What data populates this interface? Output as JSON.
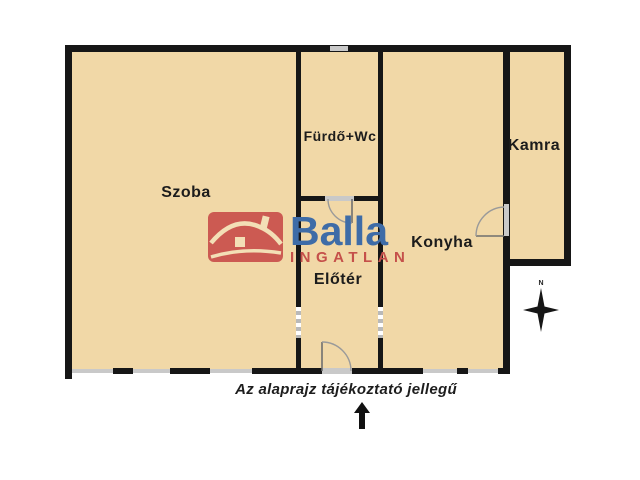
{
  "title": "Alaprajz",
  "colors": {
    "background": "#ffffff",
    "floor": "#f1d8a7",
    "wall": "#161616",
    "window": "#c9c9c9",
    "door": "#8a8a8a",
    "label": "#1c1c1c",
    "brand_blue": "#3e6ca7",
    "brand_red": "#c5504a",
    "house_icon_red": "#cc5a52",
    "house_icon_cream": "#f3dfb6"
  },
  "rooms": [
    {
      "id": "szoba",
      "label": "Szoba"
    },
    {
      "id": "furdo",
      "label": "Fürdő+Wc"
    },
    {
      "id": "kamra",
      "label": "Kamra"
    },
    {
      "id": "konyha",
      "label": "Konyha"
    },
    {
      "id": "eloter",
      "label": "Előtér"
    }
  ],
  "watermark": {
    "brand": "Balla",
    "subtitle": "INGATLAN",
    "icon": "house-icon"
  },
  "compass": {
    "label": "N"
  },
  "footer": {
    "disclaimer": "Az alaprajz tájékoztató jellegű"
  }
}
